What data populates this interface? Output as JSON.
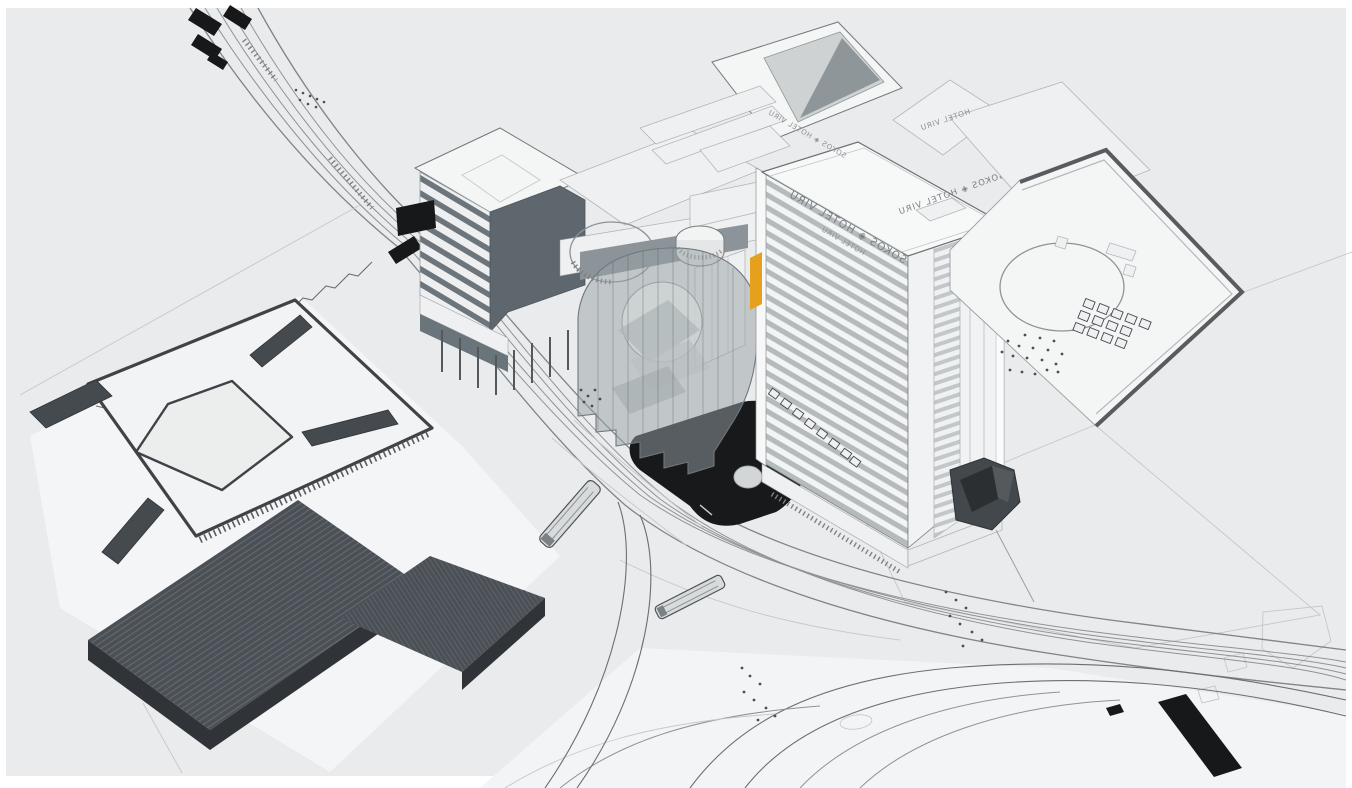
{
  "scene": {
    "title": "Sokos Hotel Viru block — aerial axonometric massing model",
    "view": "3D model viewport"
  },
  "signage": {
    "tower_roof_sign": "SOKOS ◈ HOTEL VIRU",
    "tower_roof_sign_small": "HOTEL VIRU",
    "terrace_sign": "SOKOS ◈ HOTEL VIRU",
    "wing_sign": "HOTEL VIRU"
  },
  "colors": {
    "ground": "#eaebec",
    "white_face": "#f4f5f5",
    "dark_roof": "#4a5056",
    "dark_side": "#303438",
    "glass_dark": "#5d676d",
    "ghost": "#97a1a5",
    "pool": "#17191b",
    "accent": "#e5a11c",
    "sculpture": "#43484c",
    "tram": "#d8dbdc",
    "line": "#6a6f73"
  },
  "objects": {
    "tower": "hotel tower with striped facade",
    "podium": "podium roof with circular plaza and skylights",
    "ghost_building": "translucent proposed volume with sphere",
    "pool": "dark reflecting pool with dome",
    "left_block": "flat-roof block with corner ridge bars",
    "dark_building": "dark L-shaped building",
    "trams": "two trams on curved tracks",
    "sculpture": "faceted dark sculpture"
  }
}
